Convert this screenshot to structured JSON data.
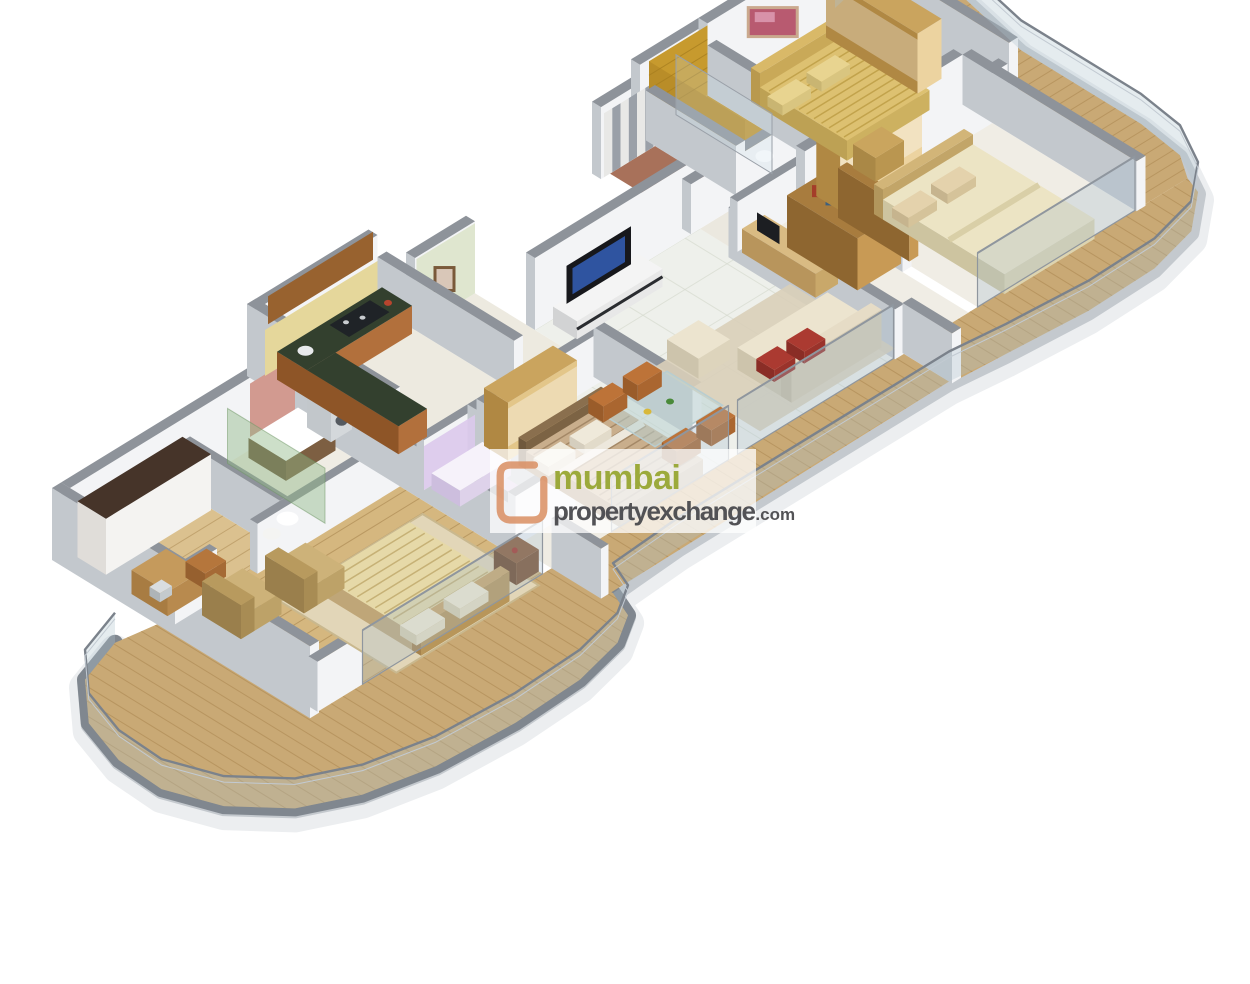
{
  "page": {
    "background": "#ffffff",
    "image_type": "isometric 3D floor plan render of a multi-bedroom apartment"
  },
  "watermark": {
    "logo_icon": "open-square-logo",
    "line1": "mumbai",
    "line2": "propertyexchange",
    "domain_suffix": ".com",
    "colors": {
      "logo": "#d98e62",
      "line1_green": "#98a733",
      "line2_gray": "#4a4a4e",
      "panel_bg": "rgba(255,255,255,0.75)"
    }
  },
  "scene": {
    "type": "floor-plan-3d",
    "rooms": [
      {
        "id": "dressing-room",
        "label": "Dressing room",
        "features": [
          "white panel wardrobe",
          "desk with laptop",
          "chair"
        ]
      },
      {
        "id": "master-bathroom",
        "label": "Master bathroom",
        "features": [
          "bathtub with wood apron",
          "toilet",
          "green glass shower",
          "red mosaic wall"
        ]
      },
      {
        "id": "master-bedroom",
        "label": "Master bedroom",
        "features": [
          "double bed",
          "two lounge chairs",
          "rug",
          "sideboard",
          "wood plank floor"
        ]
      },
      {
        "id": "lavender-bathroom",
        "label": "Bathroom with lavender tiles",
        "features": [
          "bathtub"
        ]
      },
      {
        "id": "bedroom-3",
        "label": "Bedroom",
        "features": [
          "double bed with brown striped spread",
          "glass-front wardrobe"
        ]
      },
      {
        "id": "kitchen",
        "label": "Kitchen",
        "features": [
          "L-shaped counter",
          "dark stone worktop",
          "hob",
          "sink",
          "wood cabinets",
          "yellow mosaic backsplash",
          "washing machine"
        ]
      },
      {
        "id": "entry-foyer",
        "label": "Entry foyer",
        "features": [
          "patterned wallpaper",
          "framed picture"
        ]
      },
      {
        "id": "living-dining",
        "label": "Living / dining room",
        "features": [
          "TV unit with flat-screen TV",
          "cream sofa with red cushions",
          "armchair",
          "glass dining table",
          "orange chairs",
          "potted plant",
          "rug"
        ]
      },
      {
        "id": "striped-bathroom",
        "label": "Bathroom with striped tiles",
        "features": [
          "shower"
        ]
      },
      {
        "id": "golden-bathroom",
        "label": "Bathroom with golden tiles",
        "features": [
          "shower",
          "toilet"
        ]
      },
      {
        "id": "bedroom-1",
        "label": "Bedroom (top right)",
        "features": [
          "double bed with gold spread",
          "wardrobe",
          "abstract painting"
        ]
      },
      {
        "id": "study",
        "label": "Study nook",
        "features": [
          "desk",
          "monitor",
          "bookshelf"
        ]
      },
      {
        "id": "bedroom-2",
        "label": "Bedroom (right)",
        "features": [
          "double bed with cream duvet",
          "glass-front wardrobe",
          "bookshelf"
        ]
      },
      {
        "id": "balconies",
        "label": "Wrap-around balconies",
        "features": [
          "wood decking",
          "glass and steel railing",
          "potted plants",
          "curved parapet"
        ]
      }
    ],
    "palette": {
      "wall_top": "#8e939a",
      "wall_face_light": "#f3f4f6",
      "wall_face_shade": "#dfe2e6",
      "tile_floor": "#edeae1",
      "wood_floor": "#d5b77f",
      "deck_wood": "#c9a975",
      "gold_tiles": "#c0952f",
      "lavender_tiles": "#dccaec",
      "shower_glass_green": "#91b987",
      "greenery": "#5d8f3c",
      "parapet_dark": "#80878f",
      "parapet_light": "#c4c9ce"
    }
  }
}
